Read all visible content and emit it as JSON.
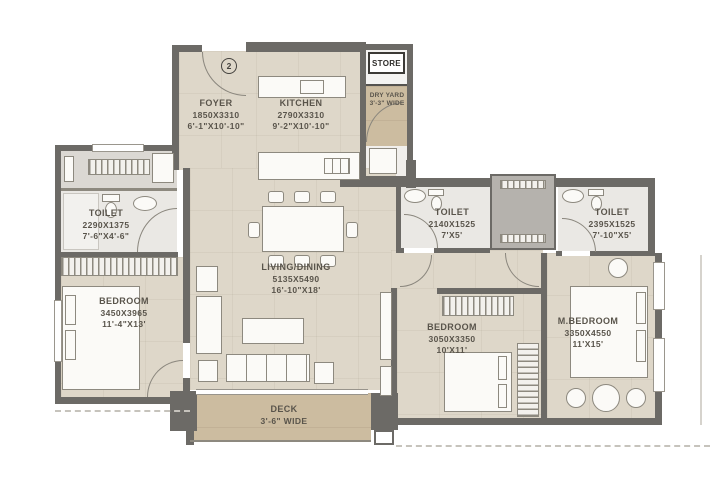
{
  "plan": {
    "entry_marker": "2",
    "rooms": {
      "foyer": {
        "name": "FOYER",
        "dim_mm": "1850X3310",
        "dim_ft": "6'-1\"X10'-10\""
      },
      "kitchen": {
        "name": "KITCHEN",
        "dim_mm": "2790X3310",
        "dim_ft": "9'-2\"X10'-10\""
      },
      "store": {
        "name": "STORE"
      },
      "dry_yard": {
        "name": "DRY YARD",
        "width_note": "3'-3\" WIDE"
      },
      "toilet_left": {
        "name": "TOILET",
        "dim_mm": "2290X1375",
        "dim_ft": "7'-6\"X4'-6\""
      },
      "bedroom_left": {
        "name": "BEDROOM",
        "dim_mm": "3450X3965",
        "dim_ft": "11'-4\"X13'"
      },
      "living_dining": {
        "name": "LIVING/DINING",
        "dim_mm": "5135X5490",
        "dim_ft": "16'-10\"X18'"
      },
      "toilet_mid": {
        "name": "TOILET",
        "dim_mm": "2140X1525",
        "dim_ft": "7'X5'"
      },
      "toilet_right": {
        "name": "TOILET",
        "dim_mm": "2395X1525",
        "dim_ft": "7'-10\"X5'"
      },
      "bedroom_mid": {
        "name": "BEDROOM",
        "dim_mm": "3050X3350",
        "dim_ft": "10'X11'"
      },
      "m_bedroom": {
        "name": "M.BEDROOM",
        "dim_mm": "3350X4550",
        "dim_ft": "11'X15'"
      },
      "deck": {
        "name": "DECK",
        "width_note": "3'-6\" WIDE"
      }
    },
    "colors": {
      "wall": "#6c6a66",
      "room_floor": "#ded7c9",
      "toilet_floor": "#eae8e4",
      "deck_floor": "#ccbca0",
      "shaft": "#b5b2ad",
      "label_text": "#59544b",
      "furniture_outline": "#8d897f",
      "background": "#ffffff"
    }
  }
}
